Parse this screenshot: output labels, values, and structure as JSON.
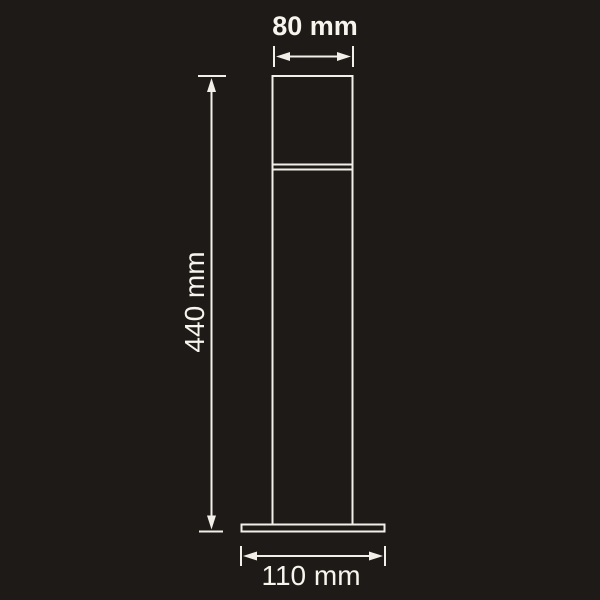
{
  "diagram": {
    "type": "technical-dimension-drawing",
    "subject": "bollard light outline (front view)",
    "dimensions": {
      "top_width": {
        "label": "80 mm",
        "measures": "width of lamp head"
      },
      "height": {
        "label": "440 mm",
        "measures": "overall height"
      },
      "base_width": {
        "label": "110 mm",
        "measures": "width of base plate"
      }
    }
  },
  "colors": {
    "background": "#1e1a17",
    "line": "#f2efe8",
    "text": "#f7f4ed"
  }
}
